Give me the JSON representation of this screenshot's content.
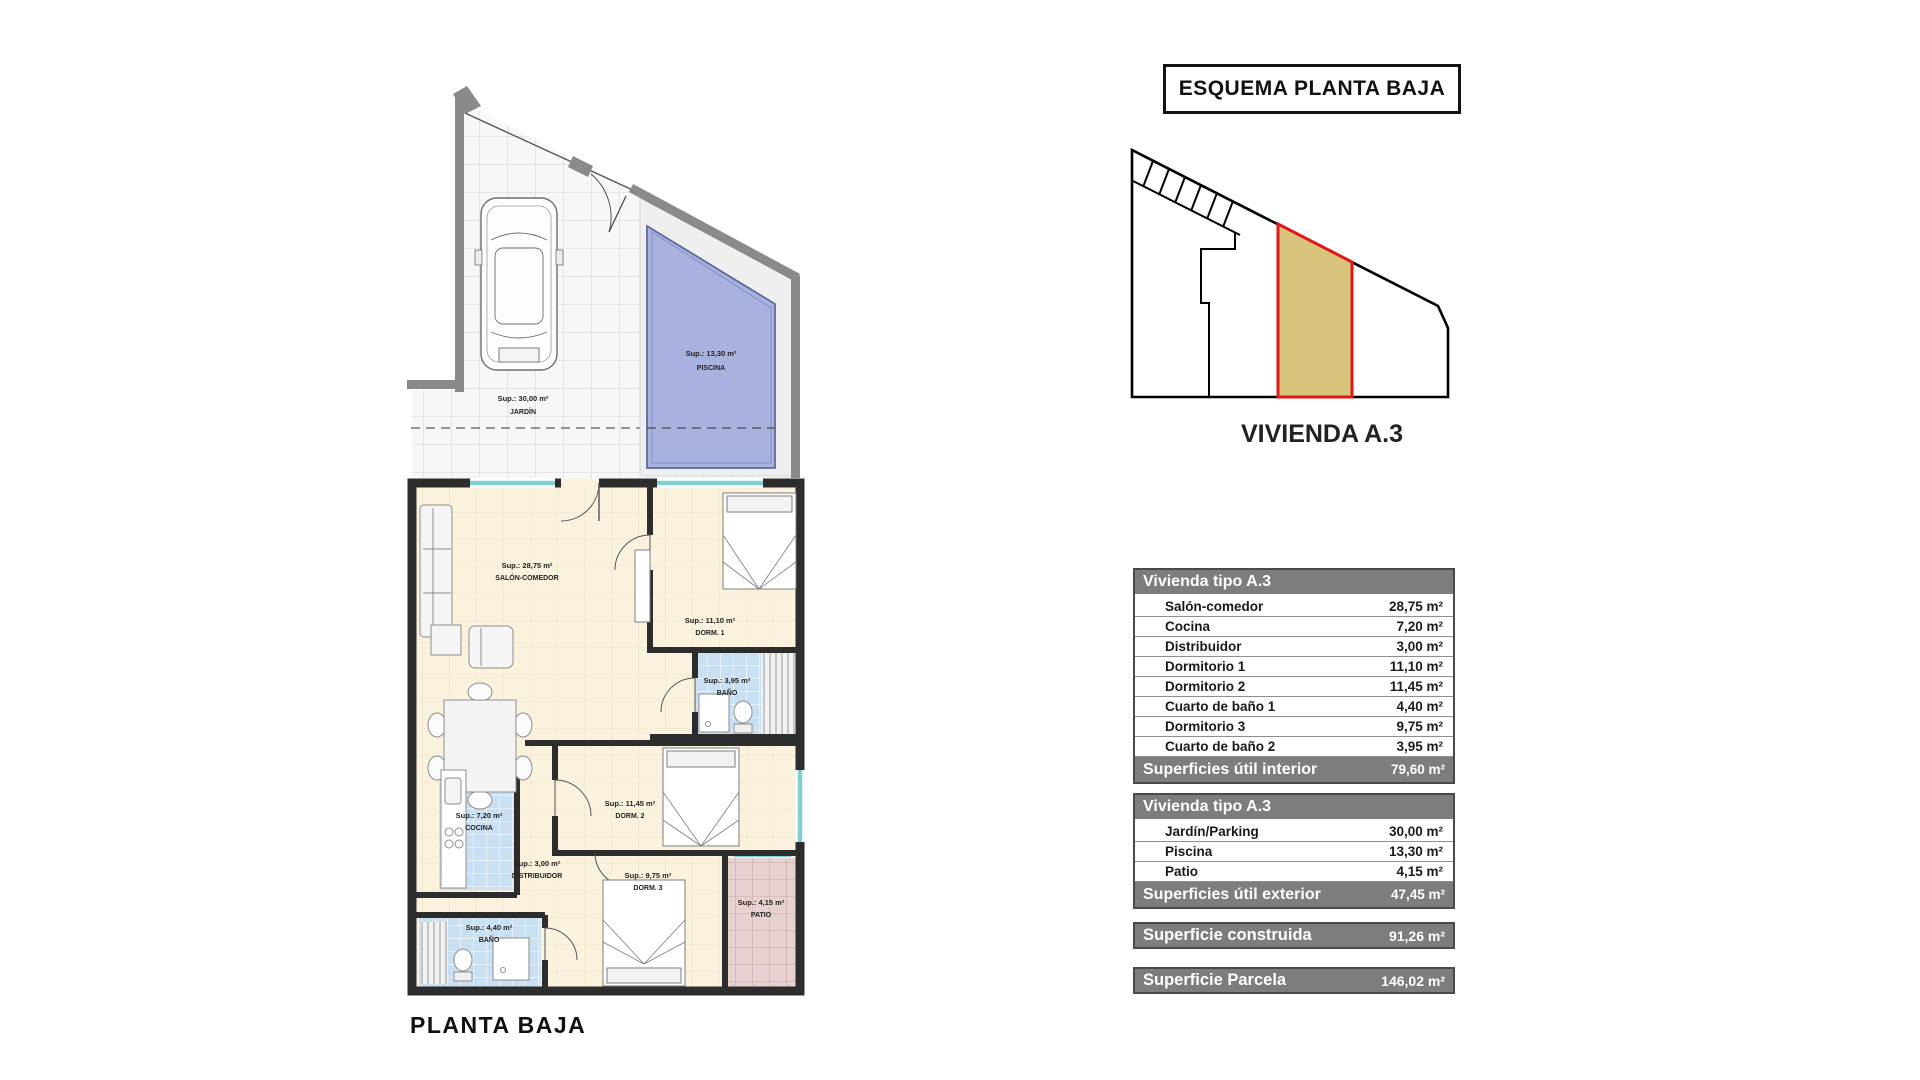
{
  "esquema": {
    "title": "ESQUEMA PLANTA BAJA",
    "unit": "VIVIENDA A.3"
  },
  "plan": {
    "title": "PLANTA BAJA",
    "jardin": {
      "sup": "Sup.: 30,00 m²",
      "name": "JARDÍN"
    },
    "piscina": {
      "sup": "Sup.: 13,30 m²",
      "name": "PISCINA"
    },
    "salon": {
      "sup": "Sup.: 28,75 m²",
      "name": "SALÓN-COMEDOR"
    },
    "dorm1": {
      "sup": "Sup.: 11,10 m²",
      "name": "DORM. 1"
    },
    "bano1": {
      "sup": "Sup.: 3,95 m²",
      "name": "BAÑO"
    },
    "cocina": {
      "sup": "Sup.: 7,20 m²",
      "name": "COCINA"
    },
    "distribuidor": {
      "sup": "Sup.: 3,00 m²",
      "name": "DISTRIBUIDOR"
    },
    "dorm2": {
      "sup": "Sup.: 11,45 m²",
      "name": "DORM. 2"
    },
    "dorm3": {
      "sup": "Sup.: 9,75 m²",
      "name": "DORM. 3"
    },
    "bano2": {
      "sup": "Sup.: 4,40 m²",
      "name": "BAÑO"
    },
    "patio": {
      "sup": "Sup.: 4,15 m²",
      "name": "PATIO"
    }
  },
  "tables": {
    "interior": {
      "header": "Vivienda tipo A.3",
      "rows": [
        {
          "label": "Salón-comedor",
          "value": "28,75 m²"
        },
        {
          "label": "Cocina",
          "value": "7,20 m²"
        },
        {
          "label": "Distribuidor",
          "value": "3,00 m²"
        },
        {
          "label": "Dormitorio 1",
          "value": "11,10 m²"
        },
        {
          "label": "Dormitorio 2",
          "value": "11,45 m²"
        },
        {
          "label": "Cuarto de baño 1",
          "value": "4,40 m²"
        },
        {
          "label": "Dormitorio 3",
          "value": "9,75 m²"
        },
        {
          "label": "Cuarto de baño 2",
          "value": "3,95 m²"
        }
      ],
      "footer_label": "Superficies útil interior",
      "footer_value": "79,60 m²"
    },
    "exterior": {
      "header": "Vivienda tipo A.3",
      "rows": [
        {
          "label": "Jardín/Parking",
          "value": "30,00 m²"
        },
        {
          "label": "Piscina",
          "value": "13,30 m²"
        },
        {
          "label": "Patio",
          "value": "4,15 m²"
        }
      ],
      "footer_label": "Superficies útil exterior",
      "footer_value": "47,45 m²"
    },
    "construida": {
      "label": "Superficie construida",
      "value": "91,26 m²"
    },
    "parcela": {
      "label": "Superficie Parcela",
      "value": "146,02 m²"
    }
  },
  "colors": {
    "highlight_parcel": "#d9c47e",
    "highlight_border": "#e01818",
    "pool_water": "#a9b2de",
    "tile_blue": "#c9dff2",
    "patio_pink": "#e7d1d1",
    "floor_cream": "#faf2dc",
    "table_header_gray": "#7d7d7d",
    "wall_dark": "#2d2d2d",
    "wall_gray": "#8a8a8a",
    "window_teal": "#7fd0cf"
  }
}
